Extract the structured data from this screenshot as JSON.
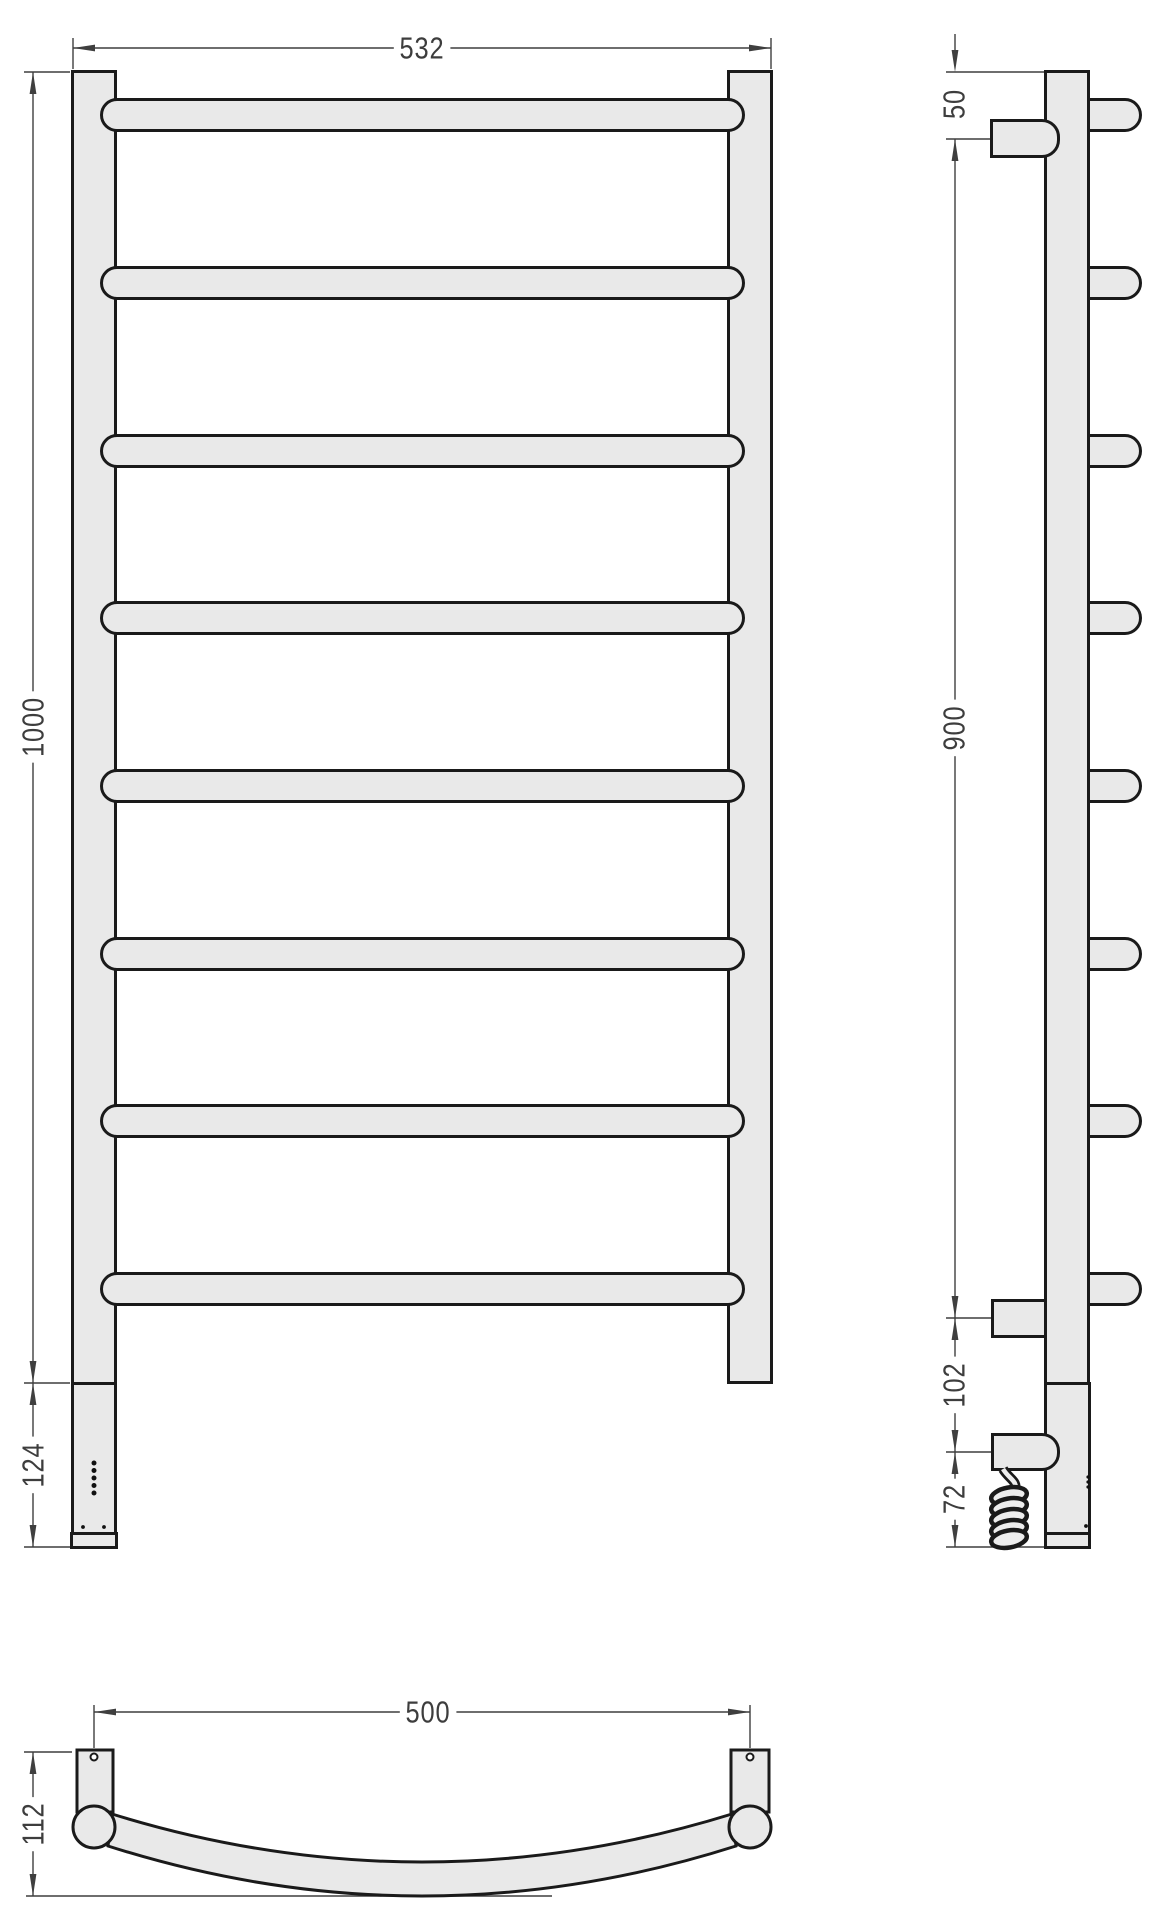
{
  "drawing_type": "towel-rail-technical-drawing",
  "views": {
    "front": {
      "width_dim": "532",
      "height_dim": "1000",
      "control_box_dim": "124"
    },
    "side": {
      "top_offset_dim": "50",
      "bracket_span_dim": "900",
      "element_offset_dim": "102",
      "cable_dim": "72"
    },
    "bottom": {
      "rail_span_dim": "500",
      "depth_dim": "112"
    }
  },
  "colors": {
    "part_fill": "#e9e9e9",
    "outline": "#1a1a1a",
    "dimension_lines": "#3f3f3f",
    "background": "#ffffff"
  }
}
